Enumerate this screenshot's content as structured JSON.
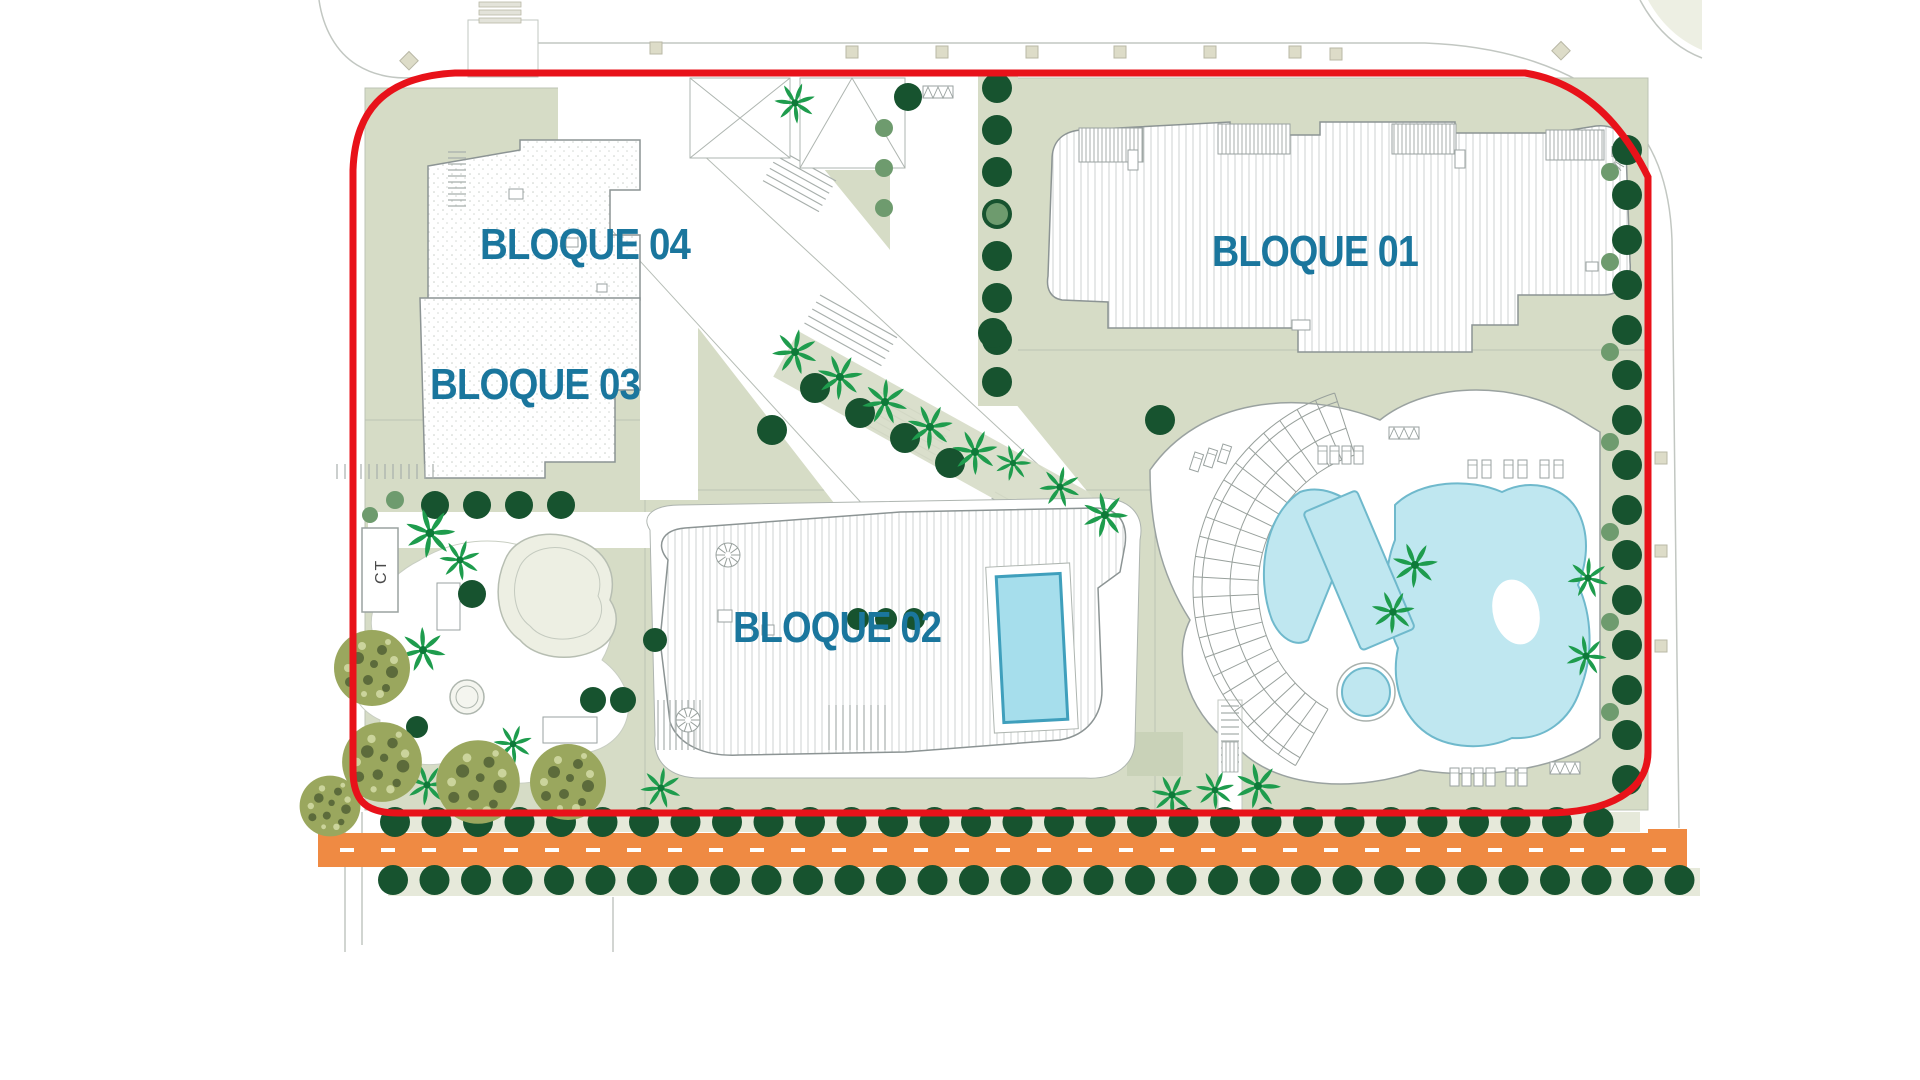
{
  "site_plan": {
    "blocks": [
      {
        "id": "bloque01",
        "label": "BLOQUE 01"
      },
      {
        "id": "bloque02",
        "label": "BLOQUE 02"
      },
      {
        "id": "bloque03",
        "label": "BLOQUE 03"
      },
      {
        "id": "bloque04",
        "label": "BLOQUE 04"
      }
    ],
    "annotations": {
      "transformer_cabin": "CT"
    },
    "colors": {
      "boundary_red": "#E8121A",
      "road_orange": "#EF8A43",
      "road_dash_white": "#FFFFFF",
      "label_blue": "#1A769D",
      "plinth_green": "#D6DCC6",
      "verge_green": "#E6E9DA",
      "pale_green": "#EDEFE3",
      "pool_fill": "#BFE7F0",
      "pool_edge": "#6FB9CC",
      "bloque02_pool_fill": "#A6DEEC",
      "bloque02_pool_edge": "#3F9FBC",
      "tree_dark": "#17532F",
      "tree_light": "#6E9B6E",
      "palm_green": "#1E9C4D",
      "palm_dark": "#0E7A39",
      "bush_base": "#9AA75E",
      "bush_dark": "#5C6B3B",
      "bush_light": "#CBD49C",
      "outline_gray": "#9AA2A0",
      "ct_text": "#4A4A4A"
    }
  }
}
